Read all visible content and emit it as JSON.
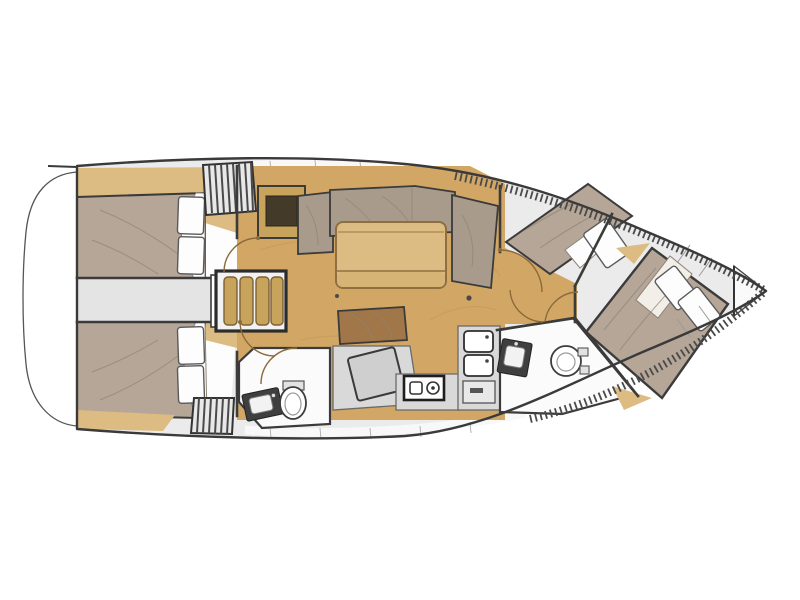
{
  "figure": {
    "type": "sailboat-interior-layout-top-view",
    "orientation": "bow-right",
    "label": "Sailing yacht interior floor plan"
  },
  "palette": {
    "hull-line": "#3a3a3a",
    "deck": "#ebebeb",
    "deck-white": "#f8f8f8",
    "wood-floor": "#d2a766",
    "wood-light": "#dcbc83",
    "wood-mid": "#c8a35c",
    "wood-dark": "#443a2a",
    "bed": "#b5a697",
    "cushion": "#a89b8b",
    "seat-brown": "#a1774a",
    "white": "#fdfdfd",
    "room-line": "#3b3b3b",
    "gray-counter": "#d9d9d9",
    "gray-mid": "#cfcfcf",
    "arc": "#8a6a3a",
    "grain": "#b8924f"
  },
  "elements": [
    "swim-platform",
    "hull",
    "aft-cabin-port",
    "aft-cabin-starboard",
    "engine-corridor",
    "companionway-steps",
    "louver-hatch-top",
    "louver-hatch-bottom",
    "saloon-floor",
    "saloon-settee",
    "saloon-table",
    "chart-locker",
    "nav-seat",
    "nav-table",
    "aft-head",
    "forward-head",
    "galley-stove",
    "galley-sink",
    "galley-cabinet",
    "forward-port-berth",
    "owner-cabin-bed",
    "anchor-locker",
    "toe-rail-hatching"
  ]
}
